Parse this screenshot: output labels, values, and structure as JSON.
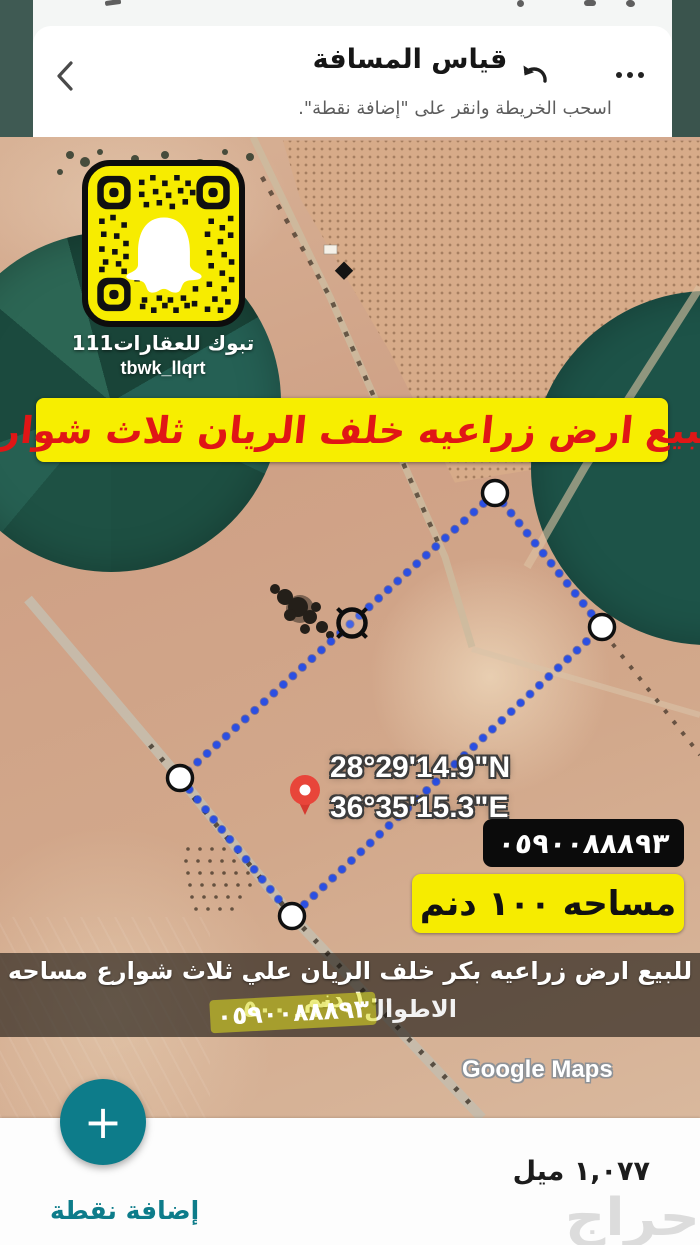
{
  "header": {
    "title": "قياس المسافة",
    "subtitle": "اسحب الخريطة وانقر على \"إضافة نقطة\"."
  },
  "snapcode": {
    "title": "تبوك للعقارات111",
    "username": "tbwk_llqrt"
  },
  "sale_banner": "للبيع ارض زراعيه خلف الريان ثلاث شوارع",
  "map": {
    "coords_n": "28°29'14.9\"N",
    "coords_e": "36°35'15.3\"E",
    "phone": "٠٥٩٠٠٨٨٨٩٣",
    "area": "مساحه ١٠٠ دنم",
    "watermark": "Google Maps"
  },
  "bottom_banner": {
    "line1": "للبيع ارض زراعيه بكر خلف الريان علي ثلاث شوارع مساحه ١٠٠ دنم",
    "line2": "الاطوال ٢٠٠ ـ ٥٠٠",
    "phone": "٠٥٩٠٠٨٨٨٩٣"
  },
  "bottom_bar": {
    "fab_icon": "+",
    "add_point": "إضافة نقطة",
    "distance": "١,٠٧٧ ميل"
  },
  "watermark": "حراج",
  "colors": {
    "teal_accent": "#0d7c8a",
    "frame_teal": "#3f5a53",
    "banner_yellow": "#f7ee00",
    "banner_red": "#e01616",
    "measure_blue": "#2b4fe2"
  }
}
